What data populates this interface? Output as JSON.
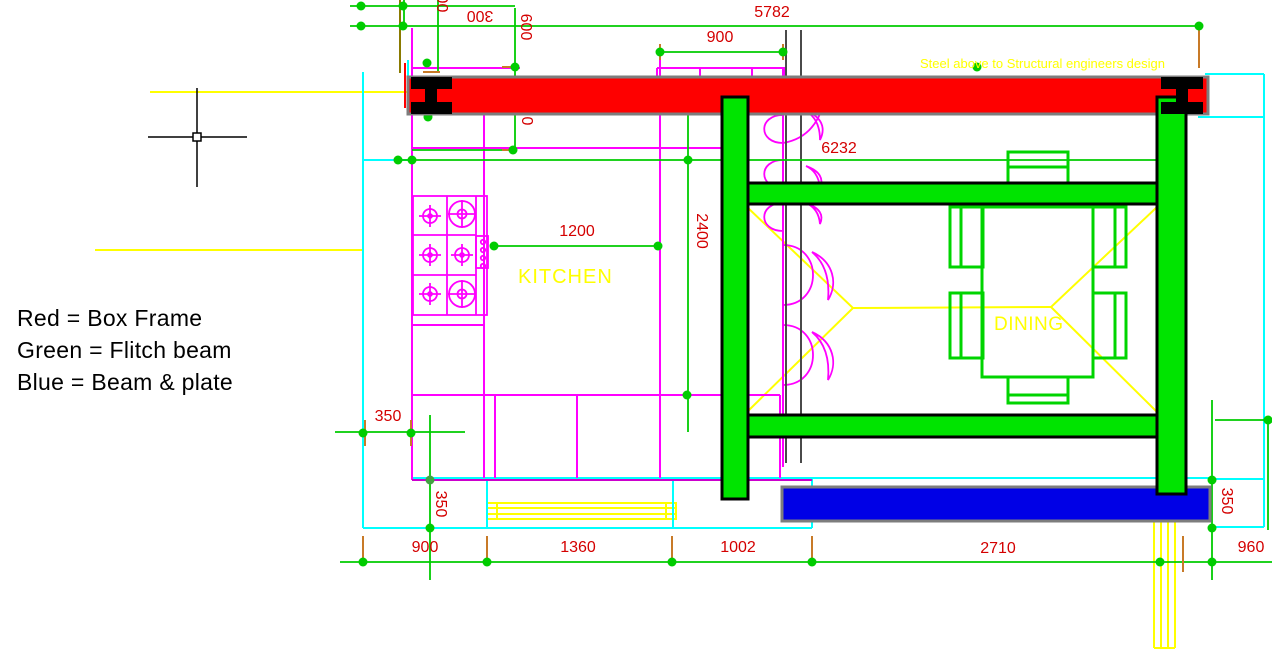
{
  "drawing": {
    "legend": {
      "red": "Red = Box Frame",
      "green": "Green = Flitch beam",
      "blue": "Blue = Beam & plate"
    },
    "labels": {
      "kitchen": "KITCHEN",
      "dining": "DINING",
      "steel_note": "Steel above to Structural engineers design"
    },
    "dimensions": {
      "top_300_clipped": "300",
      "top_300": "300",
      "top_600": "600",
      "top_5782": "5782",
      "top_900": "900",
      "zero": "0",
      "d6232": "6232",
      "v2400": "2400",
      "d1200": "1200",
      "left_350": "350",
      "left_350_v": "350",
      "bottom_900": "900",
      "bottom_1360": "1360",
      "bottom_1002": "1002",
      "bottom_2710": "2710",
      "bottom_960": "960",
      "right_350": "350"
    },
    "colors": {
      "box_frame": "#fe0000",
      "flitch_beam": "#00e400",
      "beam_plate": "#0000e6",
      "beam_border": "#7d7d7d",
      "dimension_text": "#d40000",
      "dimension_line": "#00cc00",
      "tick": "#c87a28",
      "label_yellow": "#ffff00",
      "outline_cyan": "#00ffff",
      "fixture_magenta": "#ff00ff",
      "wall_gray": "#4a4a4a"
    }
  }
}
